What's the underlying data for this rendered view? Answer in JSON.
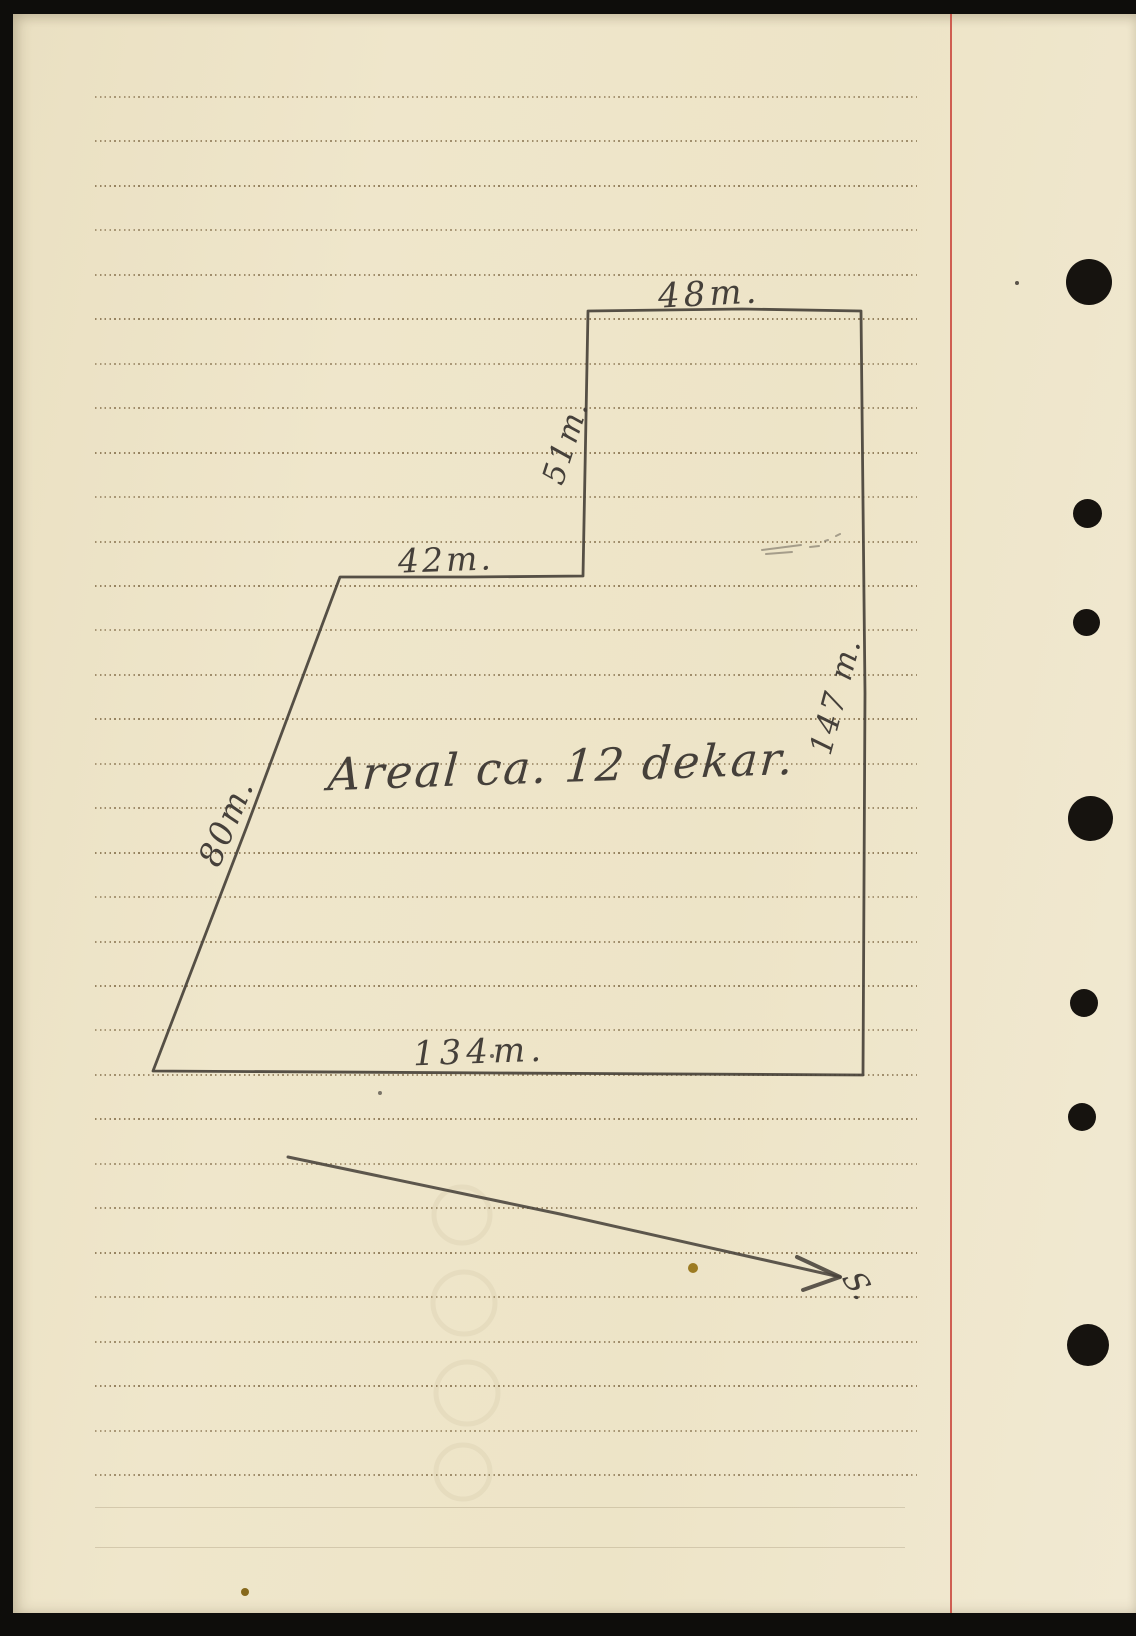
{
  "labels": {
    "top_edge": "48m.",
    "upper_vertical_edge": "51m.",
    "middle_horizontal_edge": "42m.",
    "right_vertical_edge": "147 m.",
    "left_diagonal_edge": "80m.",
    "bottom_edge": "134m.",
    "area": "Areal ca. 12 dekar.",
    "direction_mark": "S."
  },
  "colors": {
    "paper": "#efe6cb",
    "ink": "#48423a",
    "rule_dots": "#826c48",
    "red_margin": "#c9473c",
    "hole": "#16130f",
    "scan_edge": "#0e0d0b"
  },
  "diagram": {
    "polygon_path": "M 588 311 L 742 309 L 861 311 L 865 693 L 863 1075 L 500 1073 L 153 1071 L 247 826 L 340 577 L 470 577 L 583 576 Z",
    "arrow_shaft_path": "M 288 1157 L 560 1214 L 840 1277",
    "arrow_head_path": "M 840 1277 L 797 1257 M 840 1277 L 803 1290",
    "smudge_path": "M 762 550 L 801 545 M 766 554 L 792 552 M 810 547 L 819 546 M 825 541 L 828 540 M 836 536 L 840 534",
    "ghost_rings_path": "M 462 1215 m -28 0 a 28 28 0 1 0 56 0 a 28 28 0 1 0 -56 0 M 464 1303 m -31 0 a 31 31 0 1 0 62 0 a 31 31 0 1 0 -62 0 M 467 1393 m -31 0 a 31 31 0 1 0 62 0 a 31 31 0 1 0 -62 0 M 463 1472 m -27 0 a 27 27 0 1 0 54 0 a 27 27 0 1 0 -54 0"
  },
  "ruling": {
    "first_y": 96,
    "spacing": 44.45,
    "count": 32,
    "x_start": 95,
    "x_end": 917,
    "faint_lines_y": [
      1507,
      1547
    ]
  },
  "punch_holes": [
    {
      "x": 1089,
      "y": 282,
      "d": 46
    },
    {
      "x": 1087,
      "y": 513,
      "d": 29
    },
    {
      "x": 1086,
      "y": 622,
      "d": 27
    },
    {
      "x": 1090,
      "y": 818,
      "d": 45
    },
    {
      "x": 1084,
      "y": 1003,
      "d": 28
    },
    {
      "x": 1082,
      "y": 1117,
      "d": 28
    },
    {
      "x": 1088,
      "y": 1345,
      "d": 42
    }
  ],
  "specks": [
    {
      "x": 693,
      "y": 1268,
      "r": 5,
      "color": "#9c7b22"
    },
    {
      "x": 245,
      "y": 1592,
      "r": 4,
      "color": "#86691c"
    },
    {
      "x": 1017,
      "y": 283,
      "r": 2,
      "color": "#5a544a"
    },
    {
      "x": 492,
      "y": 1056,
      "r": 2,
      "color": "#6a645a"
    },
    {
      "x": 380,
      "y": 1093,
      "r": 2,
      "color": "#7a7468"
    }
  ]
}
